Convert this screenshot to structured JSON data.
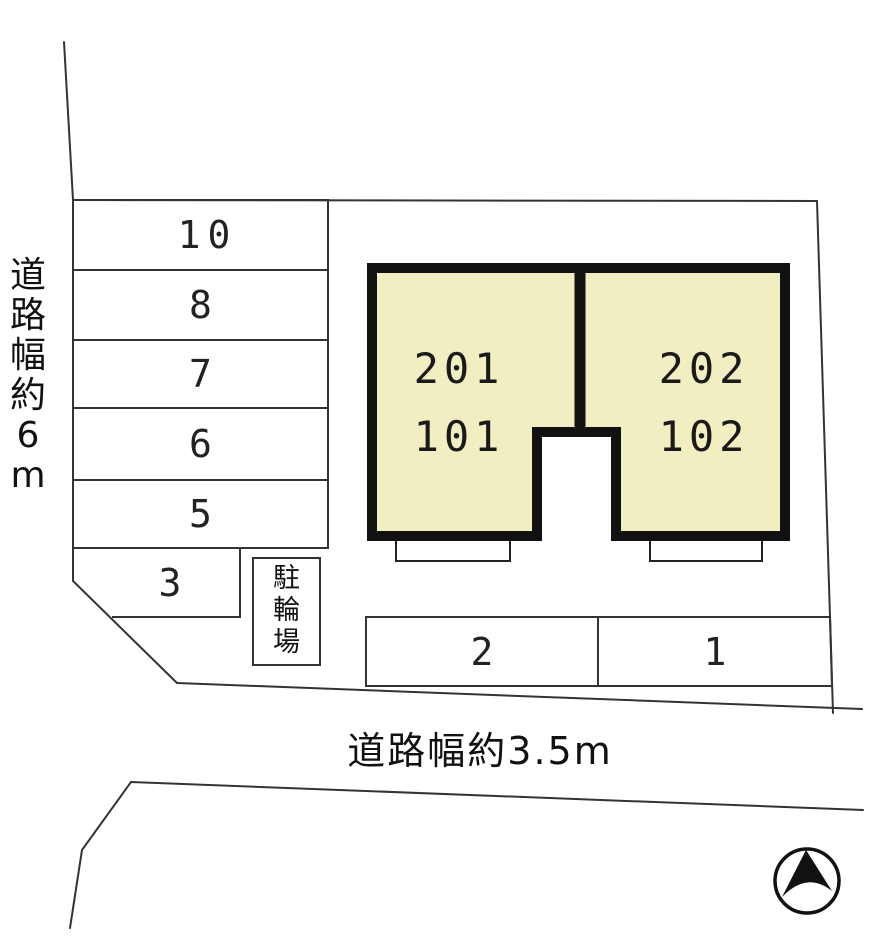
{
  "page": {
    "background": "#ffffff",
    "line_color": "#333333",
    "building_border_color": "#111111"
  },
  "roads": {
    "left": {
      "label": "道路幅約6m",
      "chars": [
        "道",
        "路",
        "幅",
        "約",
        "6",
        "m"
      ]
    },
    "bottom": {
      "label": "道路幅約3.5m"
    }
  },
  "building": {
    "fill_color": "#f1eec1",
    "left_unit": {
      "upper": "201",
      "lower": "101"
    },
    "right_unit": {
      "upper": "202",
      "lower": "102"
    }
  },
  "parking": {
    "left_column_spaces": [
      "10",
      "8",
      "7",
      "6",
      "5"
    ],
    "corner_space": "3",
    "bottom_row_spaces": [
      "2",
      "1"
    ]
  },
  "bicycle_parking": {
    "label": "駐輪場",
    "chars": [
      "駐",
      "輪",
      "場"
    ]
  },
  "compass": {
    "type": "north-arrow"
  }
}
